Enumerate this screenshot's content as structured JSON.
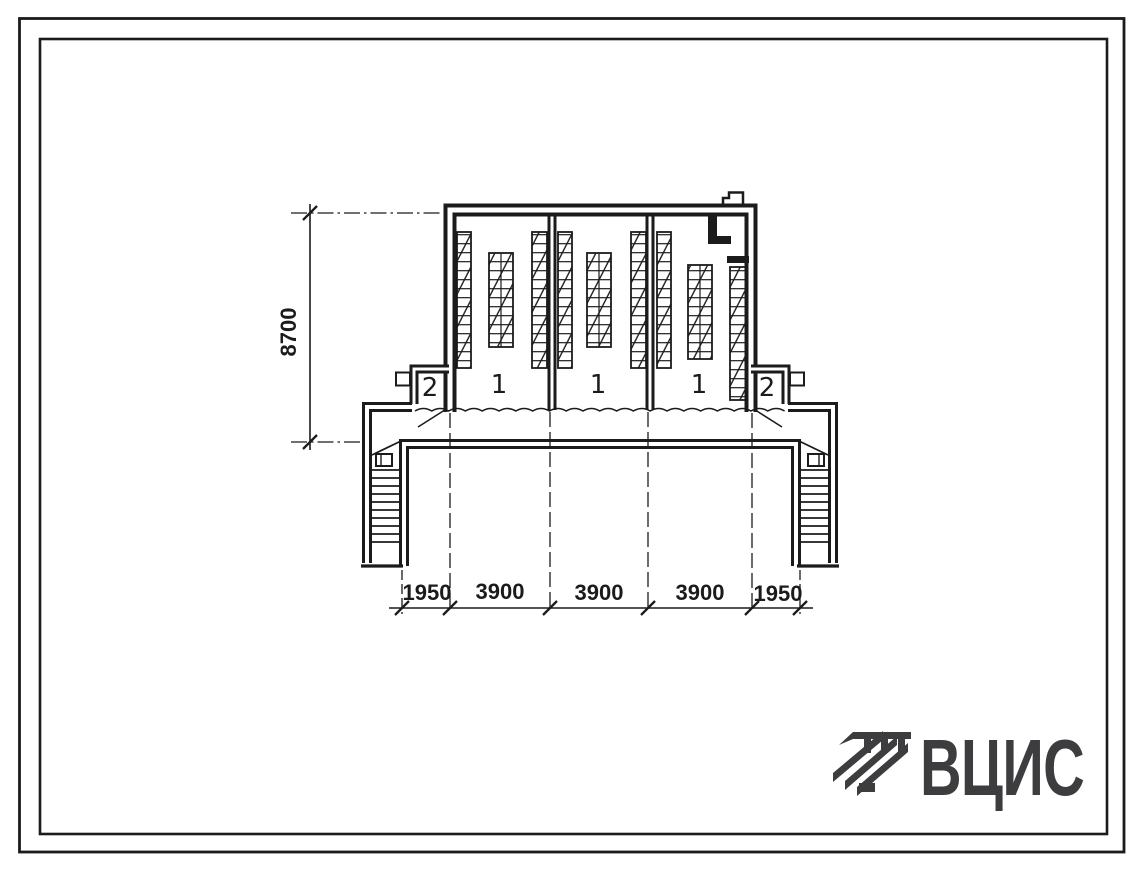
{
  "drawing": {
    "kind": "building-cross-section",
    "dimensions": {
      "vertical": "8700",
      "horizontal": [
        "1950",
        "3900",
        "3900",
        "3900",
        "1950"
      ]
    },
    "rooms": {
      "labels": [
        "2",
        "1",
        "1",
        "1",
        "2"
      ]
    },
    "logo": {
      "text": "ВЦИС",
      "icon": "vcis-diagonal-stripes-mark"
    },
    "colors": {
      "ink": "#1b1b1b",
      "logo_ink": "#3d3d3f",
      "paper": "#ffffff"
    }
  }
}
